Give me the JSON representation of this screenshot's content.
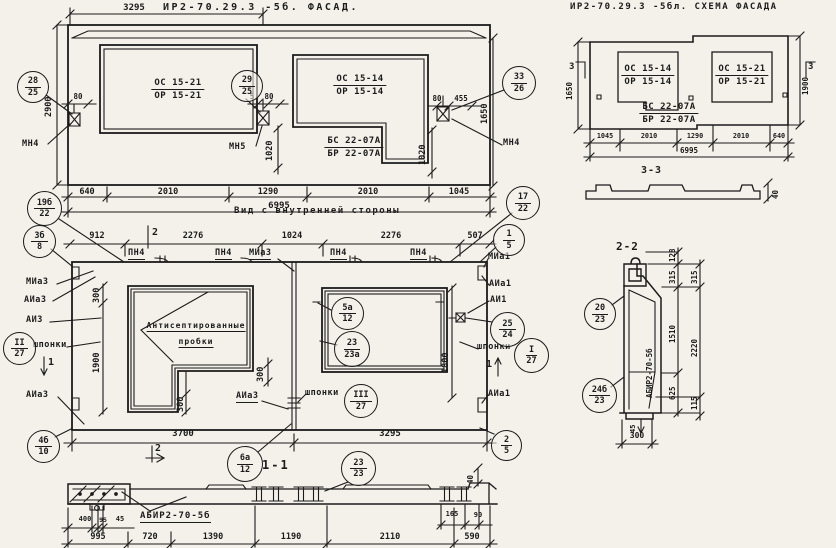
{
  "facade": {
    "title": "ИР2-70.29.3 -5б. ФАСАД.",
    "dim_top": "3295",
    "win1_top": "ОС 15-21",
    "win1_bot": "ОР 15-21",
    "win2_top": "ОС 15-14",
    "win2_bot": "ОР 15-14",
    "bs_top": "БС 22-07А",
    "bs_bot": "БР 22-07А",
    "mn4_left": "МН4",
    "mn5": "МН5",
    "mn4_right": "МН4",
    "d80_left": "80",
    "d5": "5",
    "d80_mid": "80",
    "d80_right": "80",
    "d455": "455",
    "d1020_left": "1020",
    "d1020_right": "1020",
    "d2900": "2900",
    "d1650": "1650",
    "bottom_dims": [
      "640",
      "2010",
      "1290",
      "2010",
      "1045"
    ],
    "total": "6995"
  },
  "schema": {
    "title": "ИР2-70.29.3 -5бл. СХЕМА ФАСАДА",
    "win1_top": "ОС 15-14",
    "win1_bot": "ОР 15-14",
    "win2_top": "ОС 15-21",
    "win2_bot": "ОР 15-21",
    "bs_top": "БС 22-07А",
    "bs_bot": "БР 22-07А",
    "d1650": "1650",
    "d1900": "1900",
    "sec3_left": "3",
    "sec3_right": "3",
    "bottom_dims": [
      "1045",
      "2010",
      "1290",
      "2010",
      "640"
    ],
    "total": "6995",
    "sec33_title": "3-3",
    "d40": "40"
  },
  "inner": {
    "title": "Вид с внутренней стороны",
    "top_dims": [
      "912",
      "2276",
      "1024",
      "2276",
      "507"
    ],
    "top_labels": [
      "ПН4",
      "ПН4",
      "МИа3",
      "ПН4",
      "ПН4"
    ],
    "left_labels": [
      "МИа3",
      "АИа3",
      "АИ3",
      "шпонки",
      "АИа3"
    ],
    "right_labels": [
      "МИа1",
      "АИа1",
      "АИ1",
      "шпонки",
      "АИа1"
    ],
    "probki1": "Антисептированные",
    "probki2": "пробки",
    "aia3_mid": "АИа3",
    "shponki_bottom": "шпонки",
    "sec2_top": "2",
    "sec2_bottom": "2",
    "sec1_left": "1",
    "sec1_right": "1",
    "d300_a": "300",
    "d1900": "1900",
    "d300_b": "300",
    "d300_c": "300",
    "d1800": "1800",
    "d3700": "3700",
    "d3295": "3295",
    "sec11_title": "1-1"
  },
  "strip": {
    "label": "АБИР2-70-5б",
    "small_dims": [
      "400",
      "95",
      "45"
    ],
    "right_dims": [
      "165",
      "90"
    ],
    "bottom_dims": [
      "995",
      "720",
      "1390",
      "1190",
      "2110",
      "590"
    ],
    "d40": "40"
  },
  "sec22": {
    "title": "2-2",
    "panel_label": "АБИР2-70-5б",
    "col1": [
      "128",
      "315",
      "1510",
      "625"
    ],
    "col2": [
      "315",
      "2220",
      "115"
    ],
    "d300": "300",
    "d45": "45"
  },
  "callouts": {
    "c1": {
      "t": "28",
      "b": "25"
    },
    "c2": {
      "t": "29",
      "b": "25"
    },
    "c3": {
      "t": "33",
      "b": "26"
    },
    "c4": {
      "t": "17",
      "b": "22"
    },
    "c5": {
      "t": "19б",
      "b": "22"
    },
    "c6": {
      "t": "3б",
      "b": "8"
    },
    "c7": {
      "t": "1",
      "b": "5"
    },
    "c8": {
      "t": "25",
      "b": "24"
    },
    "c9": {
      "t": "I",
      "b": "27"
    },
    "c10": {
      "t": "II",
      "b": "27"
    },
    "c11": {
      "t": "III",
      "b": "27"
    },
    "c12": {
      "t": "5а",
      "b": "12"
    },
    "c13": {
      "t": "23",
      "b": "23а"
    },
    "c14": {
      "t": "4б",
      "b": "10"
    },
    "c15": {
      "t": "6а",
      "b": "12"
    },
    "c16": {
      "t": "23",
      "b": "23"
    },
    "c17": {
      "t": "2",
      "b": "5"
    },
    "c18": {
      "t": "20",
      "b": "23"
    },
    "c19": {
      "t": "24б",
      "b": "23"
    }
  }
}
